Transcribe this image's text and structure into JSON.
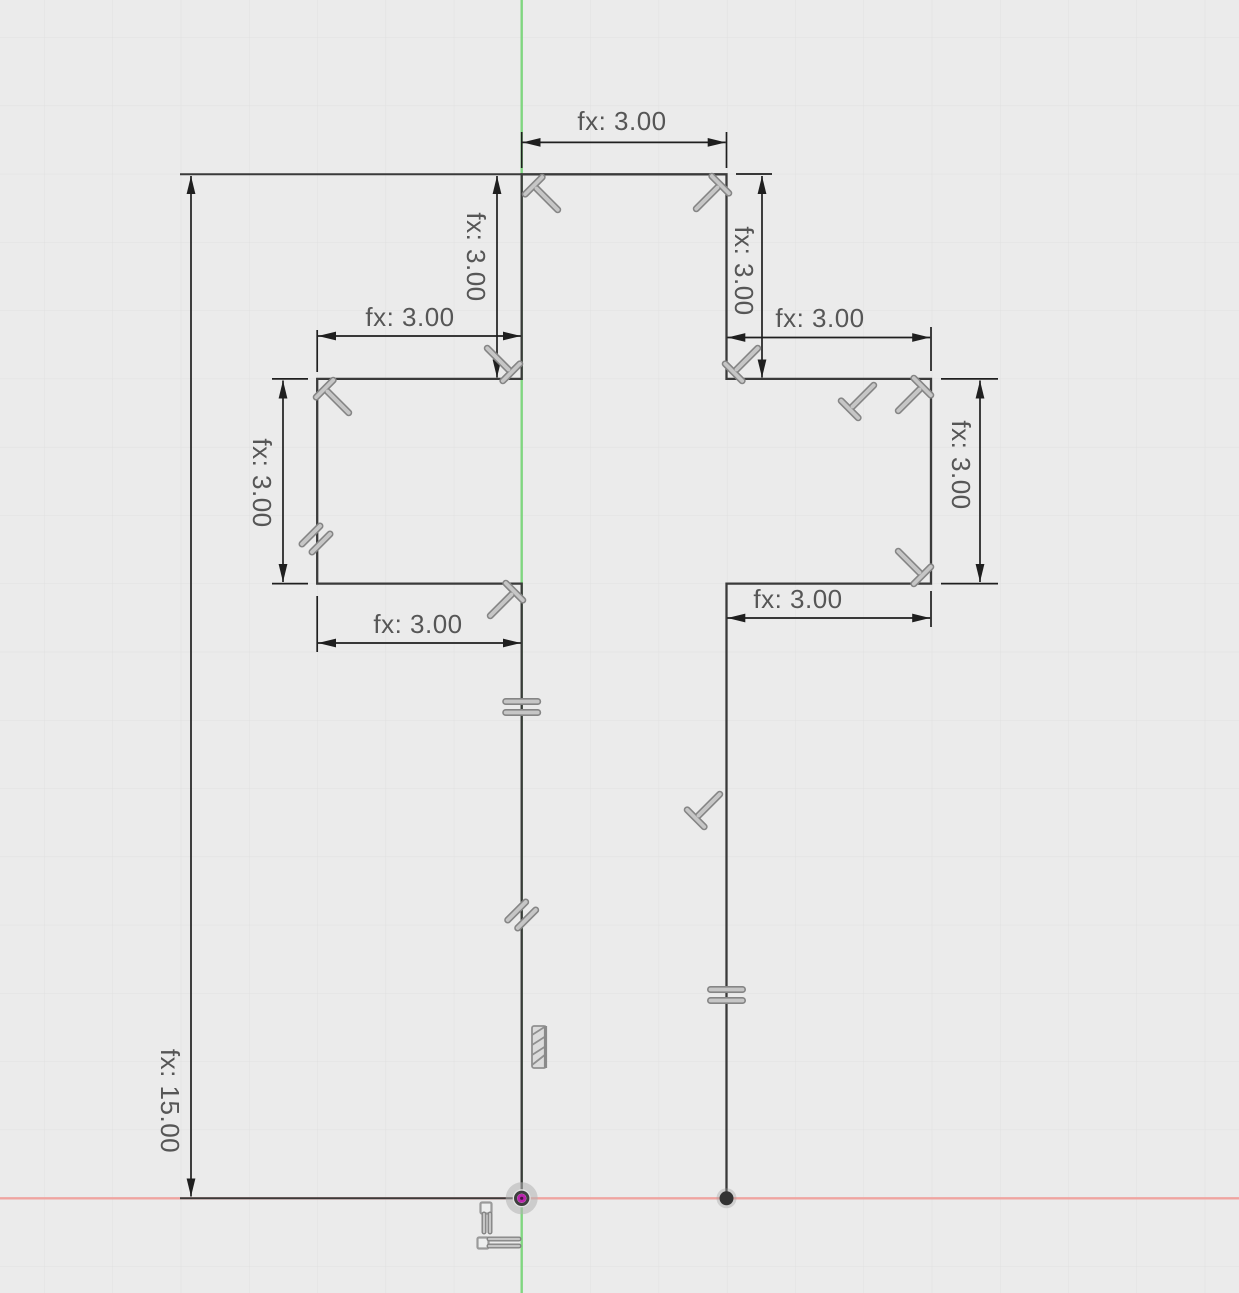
{
  "app": {
    "view_name": "sketch-canvas",
    "description_visible": "2D sketch of cross-shaped profile with driven dimensions"
  },
  "canvas": {
    "background_color": "#ebebeb",
    "grid_color": "#e0e0e0",
    "grid_spacing_px": 68.27,
    "grid_offset_x": 44.2,
    "grid_offset_y": 37.3
  },
  "axes": {
    "y_axis_color": "#80d680",
    "x_axis_color": "#efa4a0"
  },
  "sketch": {
    "line_color": "#3a3a3a",
    "dimension_color": "#1f1f1f",
    "text_color": "#565656",
    "constraint_fill": "#c6c6c6",
    "constraint_outline": "#858585",
    "origin_point_color": "#bb24ad",
    "vertex_point_color": "#333333"
  },
  "dimensions": {
    "top_width": {
      "label": "fx: 3.00",
      "value": 3.0,
      "orientation": "horizontal"
    },
    "upper_left_height": {
      "label": "fx: 3.00",
      "value": 3.0,
      "orientation": "vertical"
    },
    "upper_right_height": {
      "label": "fx: 3.00",
      "value": 3.0,
      "orientation": "vertical"
    },
    "left_arm_top_width": {
      "label": "fx: 3.00",
      "value": 3.0,
      "orientation": "horizontal"
    },
    "left_arm_height": {
      "label": "fx: 3.00",
      "value": 3.0,
      "orientation": "vertical"
    },
    "left_arm_bottom_width": {
      "label": "fx: 3.00",
      "value": 3.0,
      "orientation": "horizontal"
    },
    "right_arm_top_width": {
      "label": "fx: 3.00",
      "value": 3.0,
      "orientation": "horizontal"
    },
    "right_arm_height": {
      "label": "fx: 3.00",
      "value": 3.0,
      "orientation": "vertical"
    },
    "right_arm_bottom_width": {
      "label": "fx: 3.00",
      "value": 15.0,
      "orientation": "horizontal"
    },
    "total_height": {
      "label": "fx: 15.00",
      "value": 15.0,
      "orientation": "vertical"
    }
  },
  "constraints": [
    {
      "type": "perpendicular",
      "count": 10
    },
    {
      "type": "parallel",
      "count": 2
    },
    {
      "type": "equal",
      "count": 2
    },
    {
      "type": "fix",
      "count": 1
    },
    {
      "type": "coincident-origin-cluster",
      "count": 1
    }
  ],
  "icons": {
    "perpendicular-constraint-icon": "rotated ⊥ glyph",
    "parallel-constraint-icon": "double slash //",
    "equal-constraint-icon": "two stacked bars =",
    "fix-constraint-icon": "hatched bar",
    "coincident-constraint-icon": "small squares + bars",
    "origin-point": "magenta dot with gray halo",
    "vertex-point": "black dot"
  }
}
